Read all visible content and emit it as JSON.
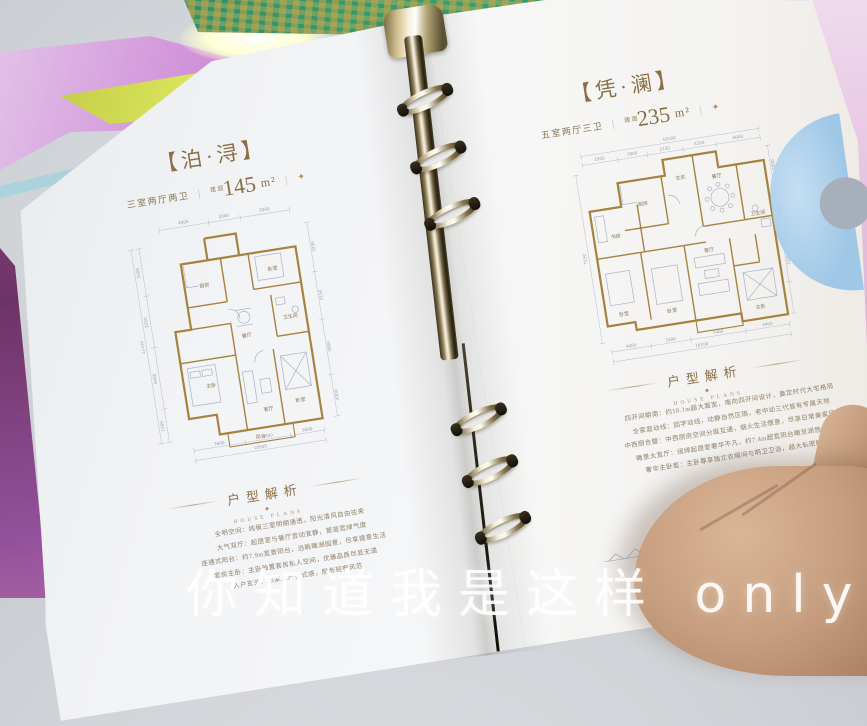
{
  "left_page": {
    "title": "【泊·浔】",
    "spec": "三室两厅两卫",
    "divider": "｜",
    "area_label": "建面",
    "area_value": "145",
    "area_unit": "m²",
    "diamond": "✦",
    "analysis_title": "户型解析",
    "analysis_en": "HOUSE PLANS",
    "analysis_dot": "◆",
    "analysis_lines": [
      "全明空间：纯板三室明朗通透，阳光清风自由往来",
      "大气双厅：起居室与餐厅宜动宜静，营造宽绰气度",
      "连通式阳台：约7.9m宽景阳台，远眺瞰湖园景，尽享惬意生活",
      "套房主卧：主卧独置套房私人空间，优雅品质尽显无遗",
      "入户玄关：归家入户仪式感，服务轻奢风范"
    ],
    "plan": {
      "rooms": [
        "厨房",
        "餐厅",
        "卧室",
        "卫生间",
        "主卧",
        "客厅",
        "卧室",
        "阳台"
      ],
      "dims_top": [
        "4000",
        "2000",
        "3000"
      ],
      "dims_bottom": [
        "3000",
        "3900",
        "3600"
      ],
      "dims_bottom_total": "10500",
      "dims_left": [
        "2500",
        "3250",
        "4400",
        "1500"
      ],
      "dims_left_total": "12100",
      "dims_right": [
        "3250",
        "2150",
        "2600",
        "4300"
      ]
    }
  },
  "right_page": {
    "title": "【凭·澜】",
    "spec": "五室两厅三卫",
    "divider": "｜",
    "area_label": "建面",
    "area_value": "235",
    "area_unit": "m²",
    "diamond": "✦",
    "analysis_title": "户型解析",
    "analysis_en": "HOUSE PLANS",
    "analysis_dot": "◆",
    "analysis_lines": [
      "四开间朝南：约18.1m超大面宽，南向四开间设计，奠定时代大宅格局",
      "全家庭动线：回字动线，动静自然区隔，老中幼三代皆有专属天地",
      "中西厨合璧：中西厨房空间分庭互通，烟火生活惬意，尽享日常美家风度",
      "瞰景大宽厅：阔绰起居室奢华不凡，约7.4m超宽阳台瞰览湖悠大境",
      "奢华主卧套：主卧尊享独立衣帽间与明卫卫浴，超大私密睡区"
    ],
    "plan": {
      "rooms": [
        "厨房",
        "玄关",
        "餐厅",
        "书房",
        "卧室",
        "卧室",
        "卫生间",
        "客厅",
        "主卧"
      ],
      "dims_top": [
        "2950",
        "1800",
        "2130",
        "3200",
        "4000"
      ],
      "dims_top_total": "18100",
      "dims_bottom": [
        "4000",
        "3300",
        "7400",
        "3400"
      ],
      "dims_bottom_total": "18100",
      "dims_left": [
        "7150"
      ],
      "dims_right": [
        "2600",
        "5000",
        "3100"
      ]
    },
    "skyline_caption": "LIVING RESORT"
  },
  "watermark": "你知道我是这样 only to you em"
}
